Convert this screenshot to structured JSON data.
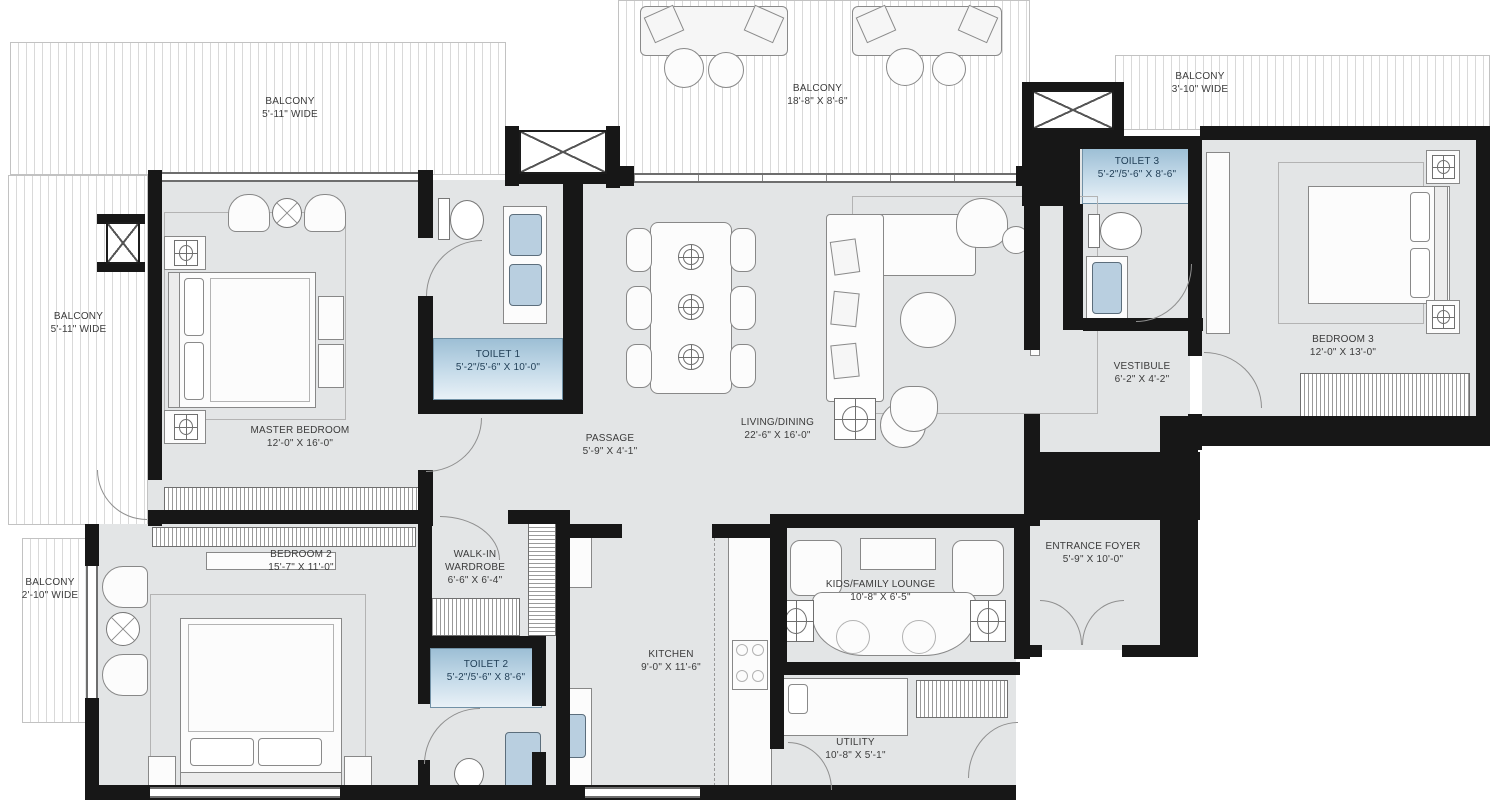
{
  "title": "Apartment Floor Plan",
  "colors": {
    "floor": "#e3e5e6",
    "wall": "#171717",
    "toilet_highlight_top": "#9dbfd5",
    "toilet_highlight_bottom": "#e9f1f7",
    "sink_fill": "#b9cfe0",
    "label_text": "#3b3b3b",
    "toilet_label_text": "#1f3d55"
  },
  "rooms": [
    {
      "id": "master_bedroom",
      "name": "MASTER BEDROOM",
      "dims": "12'-0\" X 16'-0\""
    },
    {
      "id": "toilet_1",
      "name": "TOILET 1",
      "dims": "5'-2\"/5'-6\" X 10'-0\""
    },
    {
      "id": "passage",
      "name": "PASSAGE",
      "dims": "5'-9\" X 4'-1\""
    },
    {
      "id": "living_dining",
      "name": "LIVING/DINING",
      "dims": "22'-6\" X 16'-0\""
    },
    {
      "id": "vestibule",
      "name": "VESTIBULE",
      "dims": "6'-2\" X 4'-2\""
    },
    {
      "id": "toilet_3",
      "name": "TOILET 3",
      "dims": "5'-2\"/5'-6\" X 8'-6\""
    },
    {
      "id": "bedroom_3",
      "name": "BEDROOM 3",
      "dims": "12'-0\" X 13'-0\""
    },
    {
      "id": "bedroom_2",
      "name": "BEDROOM 2",
      "dims": "15'-7\" X 11'-0\""
    },
    {
      "id": "walk_in_wardrobe",
      "name": "WALK-IN WARDROBE",
      "dims": "6'-6\" X 6'-4\""
    },
    {
      "id": "toilet_2",
      "name": "TOILET 2",
      "dims": "5'-2\"/5'-6\" X 8'-6\""
    },
    {
      "id": "kitchen",
      "name": "KITCHEN",
      "dims": "9'-0\" X 11'-6\""
    },
    {
      "id": "kids_family_lounge",
      "name": "KIDS/FAMILY LOUNGE",
      "dims": "10'-8\" X 6'-5\""
    },
    {
      "id": "utility",
      "name": "UTILITY",
      "dims": "10'-8\" X 5'-1\""
    },
    {
      "id": "entrance_foyer",
      "name": "ENTRANCE FOYER",
      "dims": "5'-9\" X 10'-0\""
    }
  ],
  "balconies": [
    {
      "id": "balcony_top_left",
      "name": "BALCONY",
      "dims": "5'-11\" WIDE"
    },
    {
      "id": "balcony_top_center",
      "name": "BALCONY",
      "dims": "18'-8\" X 8'-6\""
    },
    {
      "id": "balcony_top_right",
      "name": "BALCONY",
      "dims": "3'-10\" WIDE"
    },
    {
      "id": "balcony_left",
      "name": "BALCONY",
      "dims": "5'-11\" WIDE"
    },
    {
      "id": "balcony_bottom_left",
      "name": "BALCONY",
      "dims": "2'-10\" WIDE"
    }
  ]
}
